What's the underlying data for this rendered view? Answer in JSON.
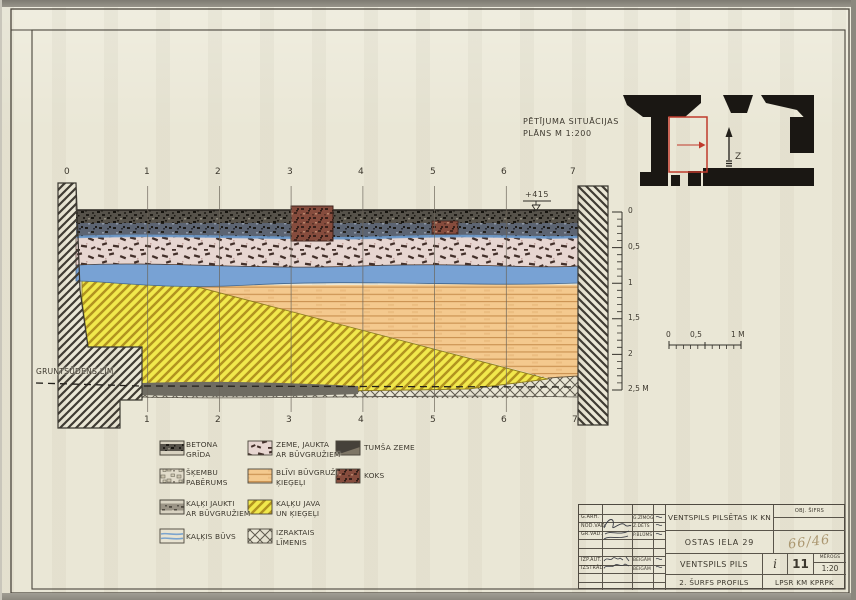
{
  "plan": {
    "title_line1": "PĒTĪJUMA SITUĀCIJAS",
    "title_line2": "PLĀNS M 1:200",
    "north_label": "Z"
  },
  "section": {
    "elevation_mark": "+415",
    "groundwater_label": "GRUNTSŪDENS LĪM.",
    "stations_top": [
      "0",
      "1",
      "2",
      "3",
      "4",
      "5",
      "6",
      "7"
    ],
    "stations_bottom": [
      "1",
      "2",
      "3",
      "4",
      "5",
      "6",
      "7"
    ],
    "vscale": [
      "0",
      "0,5",
      "1",
      "1,5",
      "2",
      "2,5 M"
    ],
    "hscale": [
      "0",
      "0,5",
      "1 M"
    ]
  },
  "legend": {
    "items": [
      {
        "id": "betona-grida",
        "line1": "BETONA",
        "line2": "GRĪDA"
      },
      {
        "id": "skembu-paberums",
        "line1": "ŠĶEMBU",
        "line2": "PABĒRUMS"
      },
      {
        "id": "kalki-jaukti",
        "line1": "KAĻĶI JAUKTI",
        "line2": "AR BŪVGRUŽIEM"
      },
      {
        "id": "kalkis-buvs",
        "line1": "KAĻĶIS BŪVS",
        "line2": ""
      },
      {
        "id": "zeme-jaukta",
        "line1": "ZEME, JAUKTA",
        "line2": "AR BŪVGRUŽIEM"
      },
      {
        "id": "blivi-buvgruzi",
        "line1": "BLĪVI BŪVGRUŽI",
        "line2": "ĶIEĢEĻI"
      },
      {
        "id": "kalku-java",
        "line1": "KAĻĶU JAVA",
        "line2": "UN ĶIEĢEĻI"
      },
      {
        "id": "izraktais-limenis",
        "line1": "IZRAKTAIS",
        "line2": "LĪMENIS"
      },
      {
        "id": "tumsa-zeme",
        "line1": "TUMŠA ZEME",
        "line2": ""
      },
      {
        "id": "koks",
        "line1": "KOKS",
        "line2": ""
      }
    ]
  },
  "titleblock": {
    "client": "VENTSPILS PILSĒTAS IK KN",
    "address": "OSTAS IELA 29",
    "object": "VENTSPILS PILS",
    "drawing_title": "2. ŠURFS PROFILS",
    "org": "LPSR KM KPRPK",
    "obj_sifrs_label": "OBJ. ŠIFRS",
    "obj_code": "66/46",
    "stage": "i",
    "sheet_no": "11",
    "scale_label": "MĒROGS",
    "scale_value": "1:20",
    "roles": [
      {
        "l1": "G.ARH.",
        "l2": "G.ZĪMOG"
      },
      {
        "l1": "NOD.VAD.",
        "l2": "Z.DĒTS"
      },
      {
        "l1": "GR.VAD.",
        "l2": "P.BLŪMS"
      },
      {
        "l1": "IZP.AUT.",
        "l2": "BEIGĀM"
      },
      {
        "l1": "IZSTRĀD.",
        "l2": "BEIGĀM"
      }
    ]
  }
}
